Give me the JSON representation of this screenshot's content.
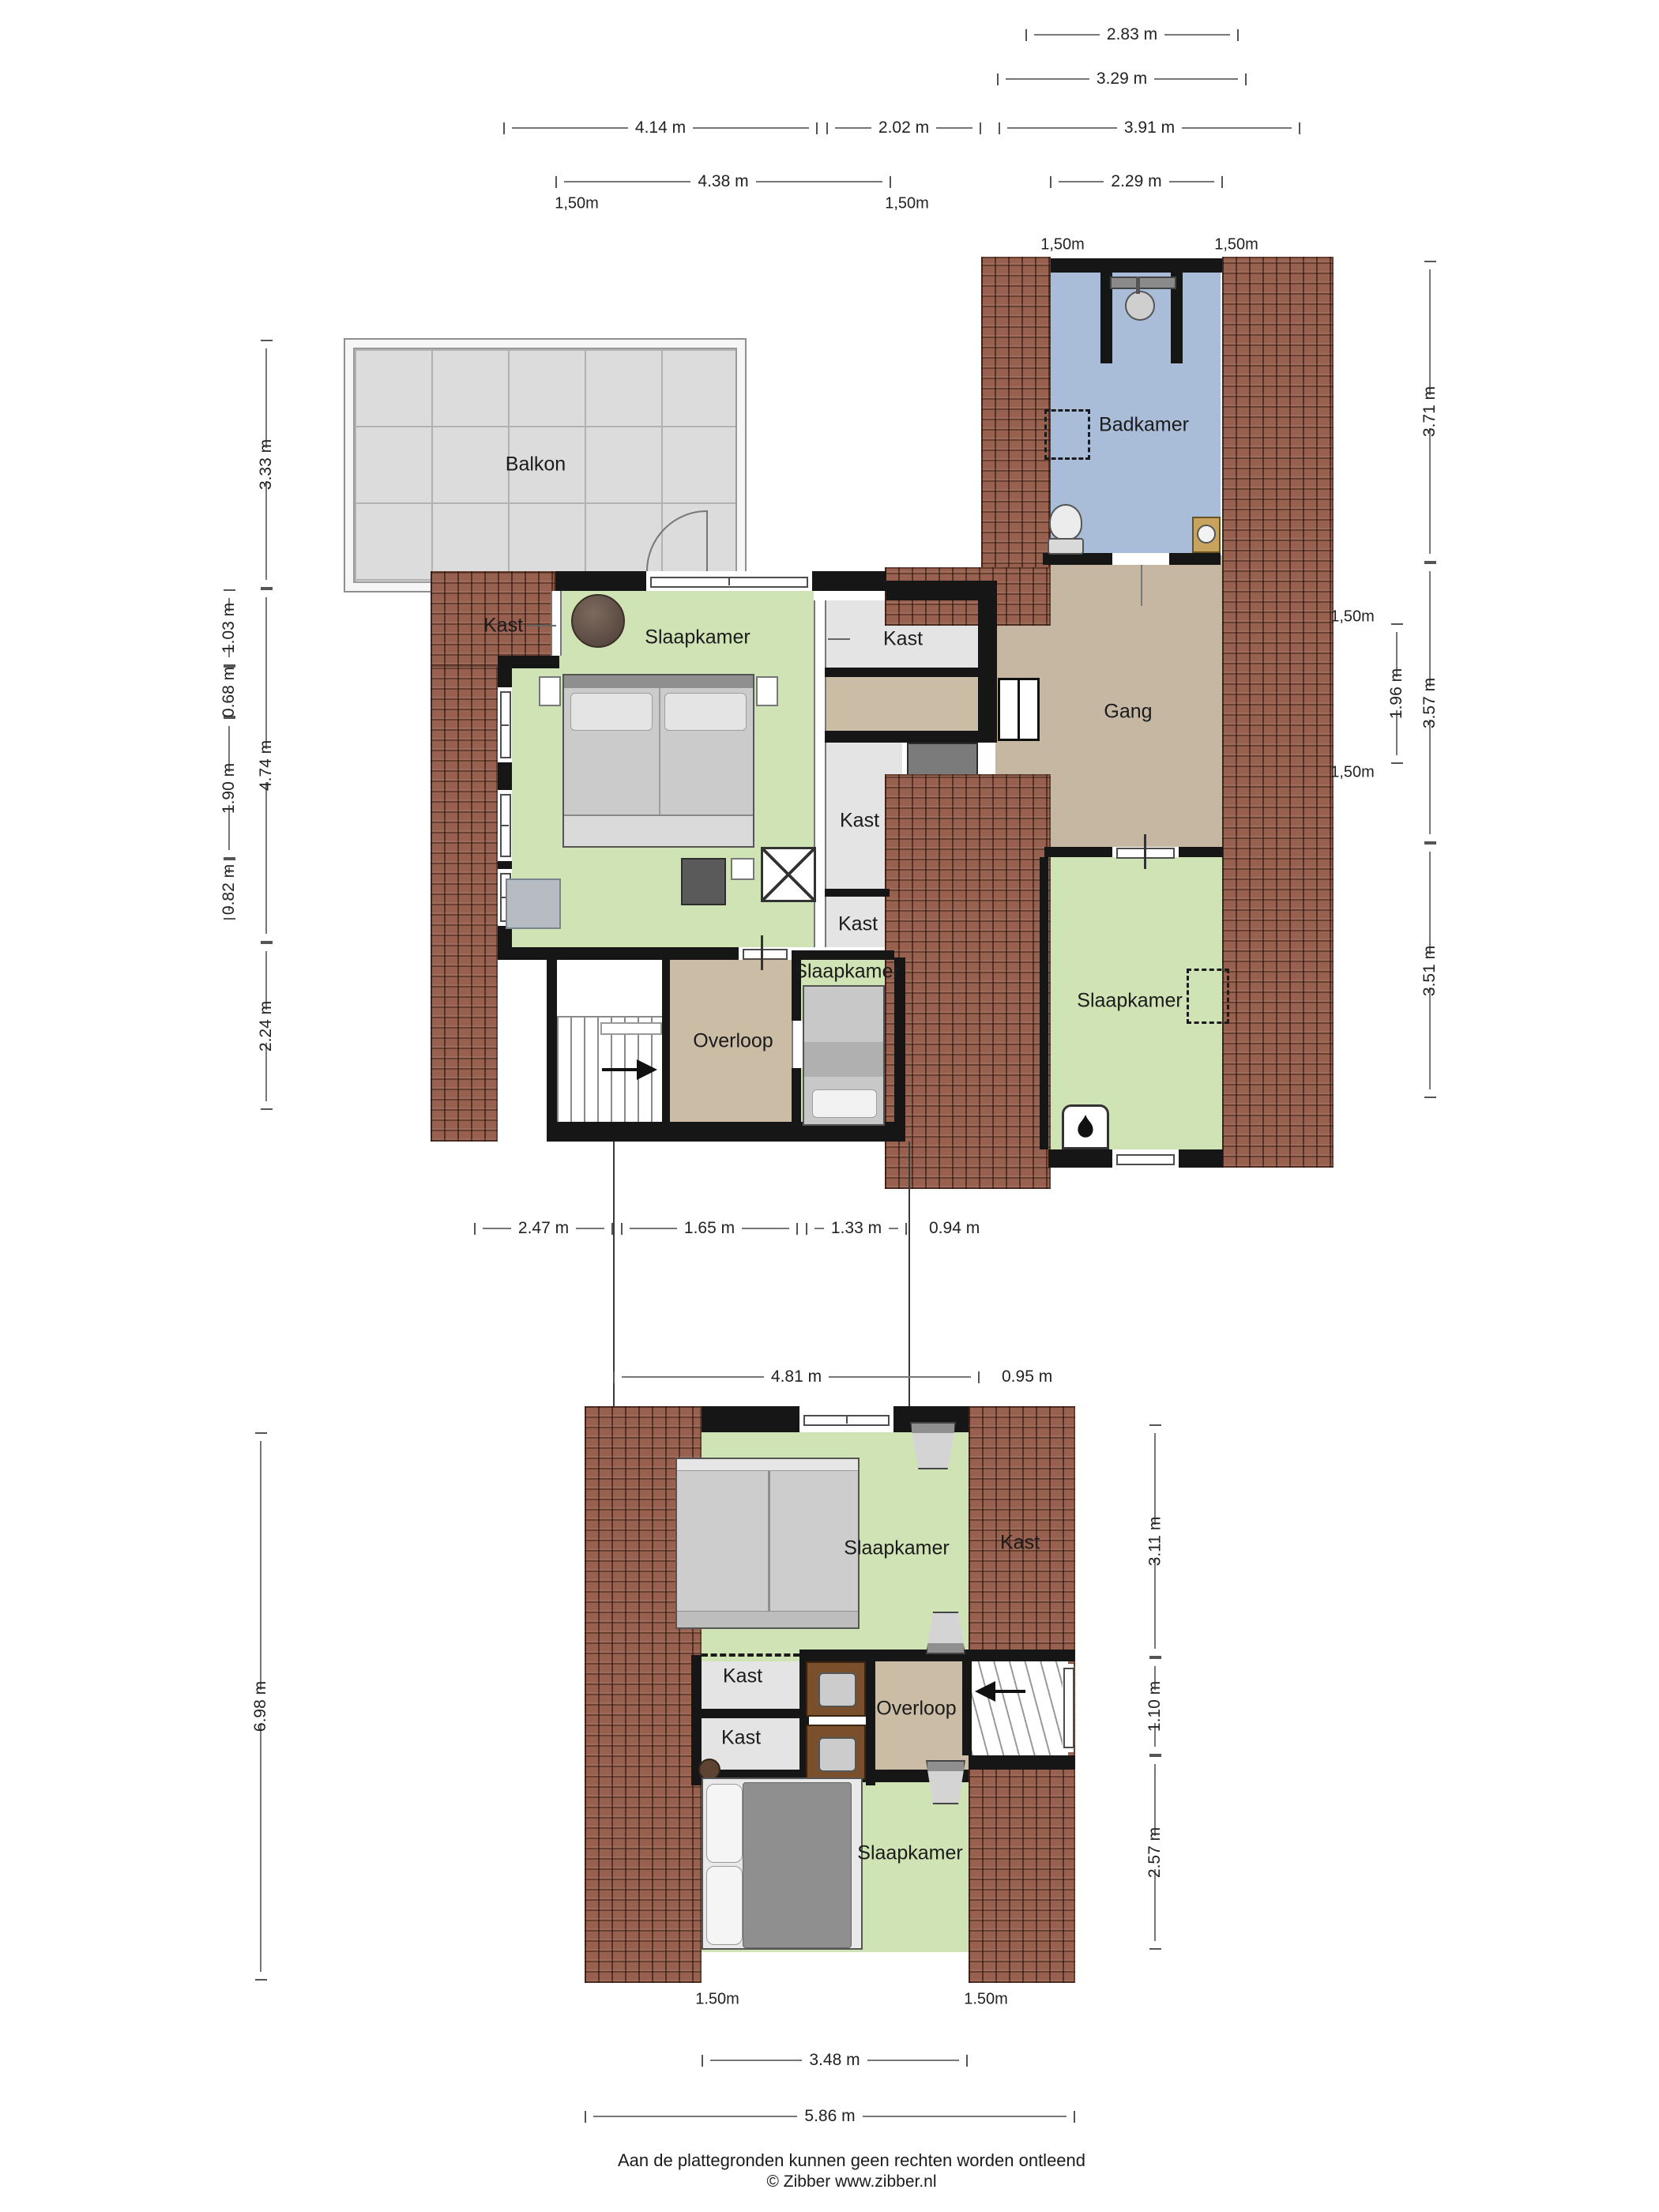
{
  "f1": {
    "balkon": "Balkon",
    "badkamer": "Badkamer",
    "slaapkamer": "Slaapkamer",
    "kast_links": "Kast",
    "kast_a": "Kast",
    "kast_b": "Kast",
    "kast_c": "Kast",
    "gang": "Gang",
    "overloop": "Overloop",
    "slaapkamer_klein": "Slaapkamer",
    "slaapkamer_rechts": "Slaapkamer"
  },
  "f2": {
    "slaapkamer_boven": "Slaapkamer",
    "kast_rechts": "Kast",
    "kast_d": "Kast",
    "kast_e": "Kast",
    "overloop": "Overloop",
    "slaapkamer_onder": "Slaapkamer"
  },
  "dims": {
    "top": [
      "2.83 m",
      "3.29 m"
    ],
    "row3": [
      "4.14 m",
      "2.02 m",
      "3.91 m"
    ],
    "row4": [
      "4.38 m",
      "2.29 m"
    ],
    "clearance_top": [
      "1,50m",
      "1,50m",
      "1,50m",
      "1,50m"
    ],
    "left_outer": [
      "3.33 m",
      "4.74 m",
      "2.24 m"
    ],
    "left_inner": [
      "1.03 m",
      "0.68 m",
      "1.90 m",
      "0.82 m"
    ],
    "right_outer": [
      "3.71 m",
      "3.57 m",
      "3.51 m"
    ],
    "right_inner_texts": [
      "1,50m",
      "1,50m"
    ],
    "right_inner_dim": "1.96 m",
    "mid_row1": [
      "2.47 m",
      "1.65 m",
      "1.33 m",
      "0.94 m"
    ],
    "mid_row2": [
      "4.81 m",
      "0.95 m"
    ],
    "second_left": "6.98 m",
    "second_right": [
      "3.11 m",
      "1.10 m",
      "2.57 m"
    ],
    "clearance_bottom": [
      "1.50m",
      "1.50m"
    ],
    "bottom": [
      "3.48 m",
      "5.86 m"
    ]
  },
  "footer": {
    "disclaimer": "Aan de plattegronden kunnen geen rechten worden ontleend",
    "copyright": "© Zibber www.zibber.nl"
  },
  "colors": {
    "roof": "#98604E",
    "room_green": "#CFE3B4",
    "room_blue": "#A9BDD8",
    "room_tan": "#CBBCA6",
    "room_gray": "#E4E4E4",
    "balkon_gray": "#DCDCDC",
    "wall": "#161616"
  }
}
